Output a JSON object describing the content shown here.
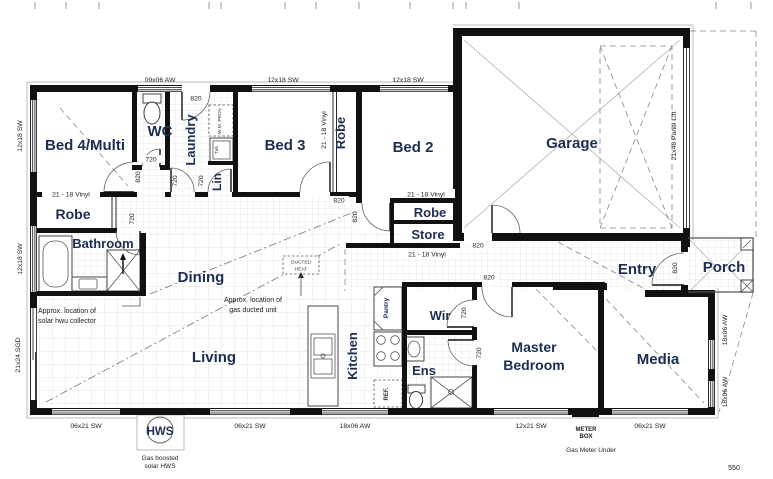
{
  "rooms": {
    "bed4": "Bed 4/Multi",
    "wc": "WC",
    "laundry": "Laundry",
    "lin": "Lin",
    "bed3": "Bed 3",
    "robe_bed3": "Robe",
    "bed2": "Bed 2",
    "garage": "Garage",
    "robe_bed4": "Robe",
    "bathroom": "Bathroom",
    "dining": "Dining",
    "robe_bed2": "Robe",
    "store": "Store",
    "entry": "Entry",
    "porch": "Porch",
    "living": "Living",
    "kitchen": "Kitchen",
    "pantry": "Pantry",
    "wir": "Wir",
    "ens": "Ens",
    "master1": "Master",
    "master2": "Bedroom",
    "media": "Media"
  },
  "windows": {
    "w0906": "09x06 AW",
    "w1218": "12x18 SW",
    "w0621": "06x21 SW",
    "w1806": "18x06 AW",
    "w2124": "21x24 SGD",
    "w1221": "12x21 SW",
    "panel": "21x48 Panel Lift"
  },
  "doors": {
    "d820": "820",
    "d720": "720"
  },
  "floor": {
    "vinyl": "21 - 18 Vinyl"
  },
  "annotations": {
    "solar1": "Approx. location of",
    "solar2": "solar hwu collector",
    "duct1": "Approx. location of",
    "duct2": "gas ducted unit",
    "dh1": "DUCTED",
    "dh2": "HEAT",
    "wm": "W.M. PROV",
    "tub": "Tub",
    "ref": "REF.",
    "hws": "HWS",
    "hws1": "Gas boosted",
    "hws2": "solar HWS",
    "meter1": "METER",
    "meter2": "BOX",
    "gas": "Gas Meter Under",
    "d550": "550"
  },
  "colors": {
    "wall": "#111111",
    "label": "#1c2e52",
    "dim": "#222222",
    "grid": "#d8d8d8"
  }
}
